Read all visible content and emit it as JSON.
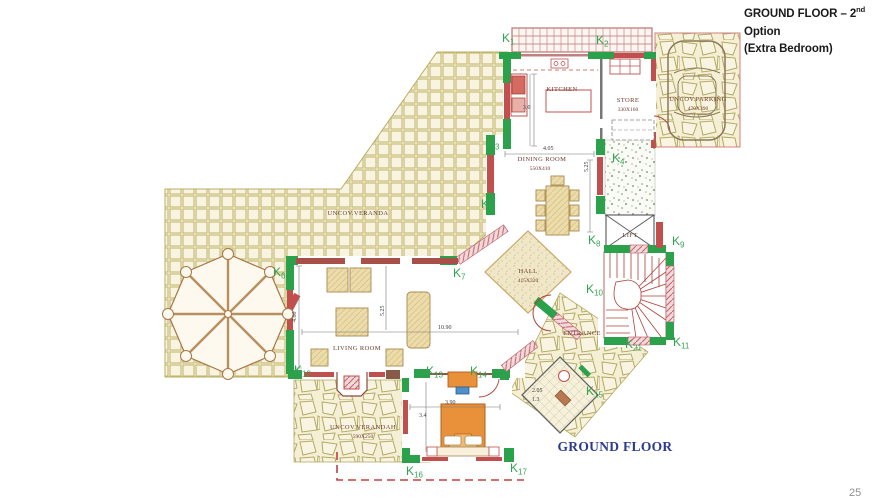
{
  "colors": {
    "wall-green": "#2aa14a",
    "wall-red": "#c0504d",
    "label-green": "#33a352",
    "tile-bg": "#f7f2dc",
    "tile-line": "#c3b96f",
    "room-text": "#6b3a2e",
    "dim-text": "#3a3a3a",
    "stair-red": "#b04038",
    "furn-tan": "#ecdcaa",
    "furn-edge": "#ab8a4e",
    "bed-orange": "#e8913a",
    "chair-blue": "#5090c8",
    "footer-blue": "#2b3a8e",
    "title-black": "#1a1a1a"
  },
  "header": {
    "title_prefix": "GROUND FLOOR – 2",
    "title_sup": "nd",
    "title_suffix": " Option",
    "subtitle": "(Extra Bedroom)"
  },
  "footer": {
    "plan_label": "GROUND FLOOR",
    "page_number": "25"
  },
  "rooms": {
    "kitchen": {
      "name": "KITCHEN"
    },
    "store": {
      "name": "STORE",
      "size": "330X160"
    },
    "parking": {
      "name": "UNCOV.PARKING",
      "size": "470X390"
    },
    "dining": {
      "name": "DINING ROOM",
      "size": "550X410"
    },
    "hall": {
      "name": "HALL",
      "size": "415X320"
    },
    "veranda": {
      "name": "UNCOV.VERANDA"
    },
    "living": {
      "name": "LIVING ROOM"
    },
    "entrance": {
      "name": "ENTRANCE"
    },
    "lift": {
      "name": "LIFT"
    },
    "verandah": {
      "name": "UNCOV.VERANDAH",
      "size": "590X250"
    }
  },
  "dimensions": {
    "kitchen_depth": "3.0",
    "dining_width": "4.05",
    "dining_depth": "5.25",
    "living_depth_left": "4.60",
    "living_depth_mid": "5.25",
    "living_width": "10.90",
    "bedroom_width": "3.90",
    "bedroom_depth": "3.4",
    "bath_length": "2.05",
    "bath_width": "1.3"
  },
  "k_labels": {
    "k1": {
      "k": "K",
      "n": "1"
    },
    "k2": {
      "k": "K",
      "n": "2"
    },
    "k3": {
      "k": "K",
      "n": "3"
    },
    "k4": {
      "k": "K",
      "n": "4"
    },
    "k5": {
      "k": "K",
      "n": "5"
    },
    "k6": {
      "k": "K",
      "n": "6"
    },
    "k7": {
      "k": "K",
      "n": "7"
    },
    "k8": {
      "k": "K",
      "n": "8"
    },
    "k9": {
      "k": "K",
      "n": "9"
    },
    "k10": {
      "k": "K",
      "n": "10"
    },
    "k11": {
      "k": "K",
      "n": "11"
    },
    "k12": {
      "k": "K",
      "n": "12"
    },
    "k13": {
      "k": "K",
      "n": "13"
    },
    "k14": {
      "k": "K",
      "n": "14"
    },
    "k15": {
      "k": "K",
      "n": "15"
    },
    "k16": {
      "k": "K",
      "n": "16"
    },
    "k17": {
      "k": "K",
      "n": "17"
    },
    "k21": {
      "k": "K",
      "n": "21"
    }
  }
}
